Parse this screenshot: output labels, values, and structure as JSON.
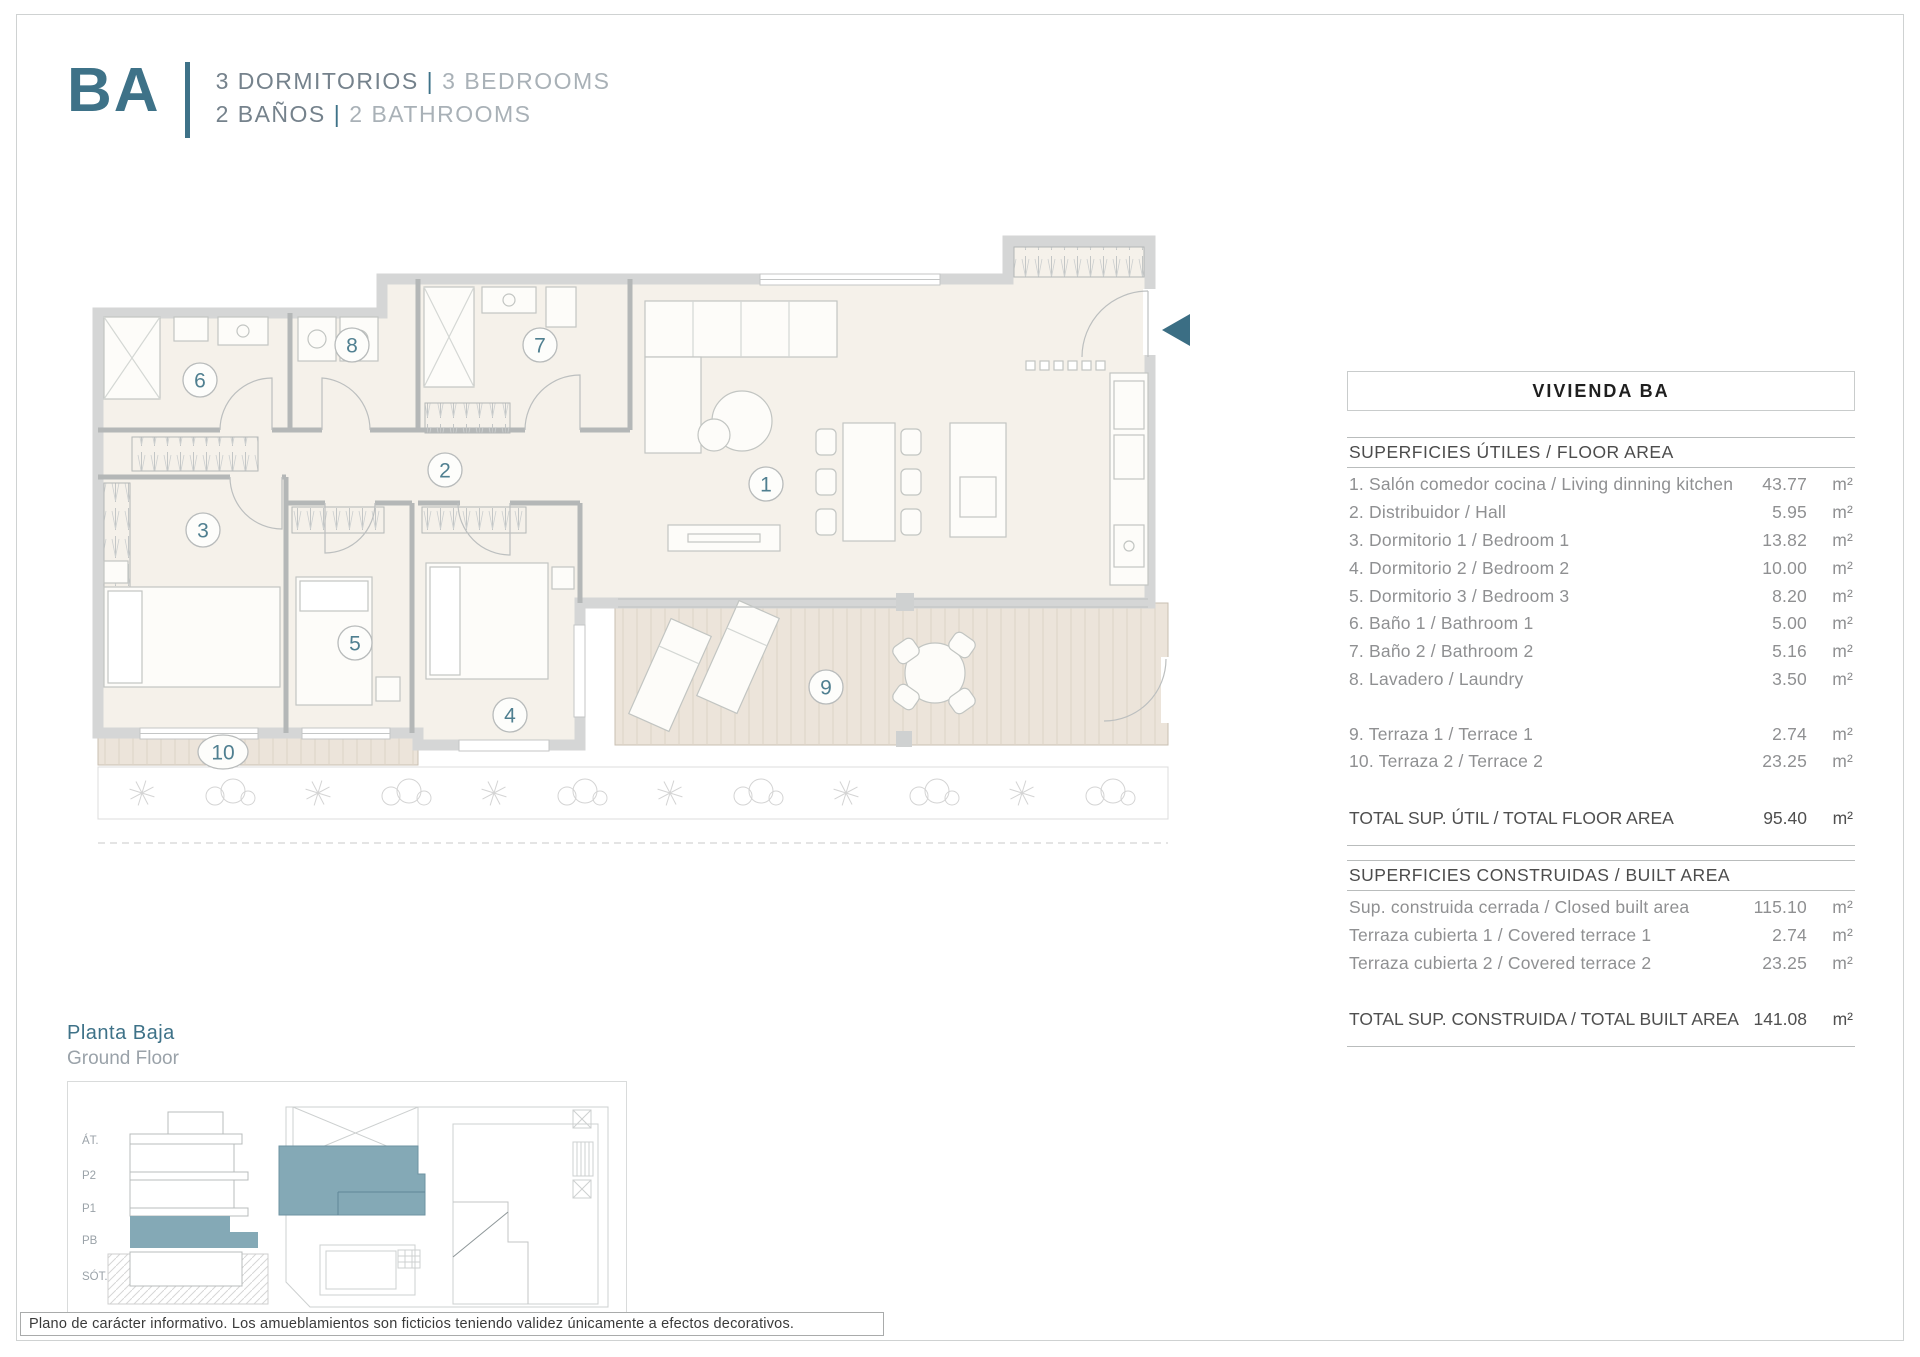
{
  "header": {
    "code": "BA",
    "line1_es": "3 DORMITORIOS",
    "line1_en": "3 BEDROOMS",
    "line2_es": "2 BAÑOS",
    "line2_en": "2 BATHROOMS",
    "pipe": "|"
  },
  "panel": {
    "title": "VIVIENDA BA",
    "floor_area": {
      "heading": "SUPERFICIES ÚTILES / FLOOR AREA",
      "rows": [
        {
          "label": "1. Salón comedor cocina / Living dinning kitchen",
          "value": "43.77",
          "unit": "m²"
        },
        {
          "label": "2. Distribuidor / Hall",
          "value": "5.95",
          "unit": "m²"
        },
        {
          "label": "3. Dormitorio 1 / Bedroom 1",
          "value": "13.82",
          "unit": "m²"
        },
        {
          "label": "4. Dormitorio 2 / Bedroom 2",
          "value": "10.00",
          "unit": "m²"
        },
        {
          "label": "5. Dormitorio 3 / Bedroom 3",
          "value": "8.20",
          "unit": "m²"
        },
        {
          "label": "6. Baño 1 / Bathroom 1",
          "value": "5.00",
          "unit": "m²"
        },
        {
          "label": "7. Baño 2 / Bathroom 2",
          "value": "5.16",
          "unit": "m²"
        },
        {
          "label": "8. Lavadero / Laundry",
          "value": "3.50",
          "unit": "m²"
        }
      ],
      "terrace_rows": [
        {
          "label": "9. Terraza 1 / Terrace 1",
          "value": "2.74",
          "unit": "m²"
        },
        {
          "label": "10. Terraza 2 / Terrace 2",
          "value": "23.25",
          "unit": "m²"
        }
      ],
      "total": {
        "label": "TOTAL SUP. ÚTIL / TOTAL FLOOR AREA",
        "value": "95.40",
        "unit": "m²"
      }
    },
    "built_area": {
      "heading": "SUPERFICIES CONSTRUIDAS / BUILT AREA",
      "rows": [
        {
          "label": "Sup. construida cerrada / Closed built area",
          "value": "115.10",
          "unit": "m²"
        },
        {
          "label": "Terraza cubierta 1 / Covered terrace 1",
          "value": "2.74",
          "unit": "m²"
        },
        {
          "label": "Terraza cubierta 2 / Covered terrace 2",
          "value": "23.25",
          "unit": "m²"
        }
      ],
      "total": {
        "label": "TOTAL SUP. CONSTRUIDA /  TOTAL BUILT AREA",
        "value": "141.08",
        "unit": "m²"
      }
    }
  },
  "plan": {
    "rooms": [
      {
        "num": "1",
        "x": 696,
        "y": 259
      },
      {
        "num": "2",
        "x": 375,
        "y": 245
      },
      {
        "num": "3",
        "x": 133,
        "y": 305
      },
      {
        "num": "4",
        "x": 440,
        "y": 490
      },
      {
        "num": "5",
        "x": 285,
        "y": 418
      },
      {
        "num": "6",
        "x": 130,
        "y": 155
      },
      {
        "num": "7",
        "x": 470,
        "y": 120
      },
      {
        "num": "8",
        "x": 282,
        "y": 120
      },
      {
        "num": "9",
        "x": 756,
        "y": 462
      },
      {
        "num": "10",
        "x": 153,
        "y": 527
      }
    ]
  },
  "footer": {
    "floor_label_es": "Planta Baja",
    "floor_label_en": "Ground Floor",
    "section_levels": [
      "ÁT.",
      "P2",
      "P1",
      "PB",
      "SÓT."
    ],
    "disclaimer": "Plano de carácter informativo. Los amueblamientos son ficticios teniendo validez únicamente a efectos decorativos."
  },
  "colors": {
    "accent_teal": "#3e7288",
    "highlight_teal": "#84a9b6",
    "wall_gray": "#d5d6d6",
    "floor_beige": "#f5f1ea",
    "deck_beige": "#ece4da"
  }
}
